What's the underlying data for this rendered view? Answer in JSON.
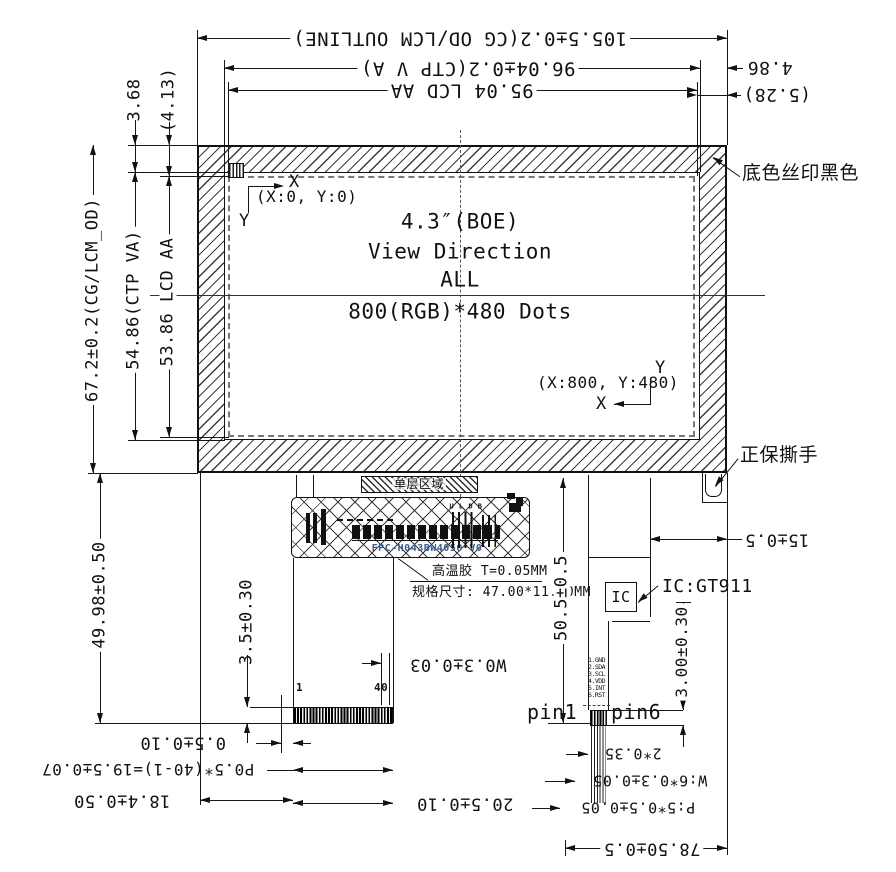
{
  "drawing": {
    "product": {
      "size": "4.3″(BOE)",
      "view_direction_label": "View Direction",
      "view_direction": "ALL",
      "resolution": "800(RGB)*480 Dots",
      "origin": "(X:0, Y:0)",
      "corner": "(X:800, Y:480)",
      "axis_x": "X",
      "axis_y": "Y"
    },
    "dims_top": {
      "outline_width": "105.5±0.2(CG OD/LCM OUTLINE)",
      "ctp_va_width": "96.04±0.2(CTP V A)",
      "lcd_aa_width": "95.04 LCD AA",
      "edge_gap": "4.86",
      "edge_gap_ref": "(5.28)"
    },
    "dims_left": {
      "top_gap": "3.68",
      "top_gap_ref": "(4.13)",
      "outline_height": "67.2±0.2(CG/LCM_OD)",
      "ctp_va_height": "54.86(CTP VA)",
      "lcd_aa_height": "53.86 LCD AA",
      "fpc_drop": "49.98±0.50"
    },
    "dims_bottom": {
      "stiffener_depth": "3.5±0.30",
      "pin_width": "W0.3±0.03",
      "pin_edge": "0.5±0.10",
      "pin_pitch": "P0.5*(40-1)=19.5±0.07",
      "conn_offset": "18.4±0.50",
      "conn_width": "20.5±0.10",
      "pin_first": "1",
      "pin_last": "40"
    },
    "dims_right": {
      "tail_inset": "15±0.5",
      "tail_drop": "50.5±0.5",
      "touch_pin_len": "3.00±0.30",
      "touch_pin_margin": "2*0.35",
      "touch_pin_width": "W:6*0.3±0.05",
      "touch_pin_pitch": "P:5*0.5±0.05",
      "tail_total": "78.50±0.5"
    },
    "annotations": {
      "silkscreen": "底色丝印黑色",
      "tear_handle": "正保撕手",
      "touch_ic": "IC:GT911",
      "ic_box": "IC",
      "pin1": "pin1",
      "pin6": "pin6",
      "single_layer_zone": "单层区域",
      "adhesive": "高温胶 T=0.05MM",
      "adhesive_spec": "规格尺寸: 47.00*11.40MM",
      "fpc_part_no": "FPC-H043BW4050 V0",
      "fpc_comp_marks": "U L D B"
    },
    "touch_pins": [
      "1.GND",
      "2.SDA",
      "3.SCL",
      "4.VDD",
      "5.INT",
      "6.RST"
    ]
  }
}
